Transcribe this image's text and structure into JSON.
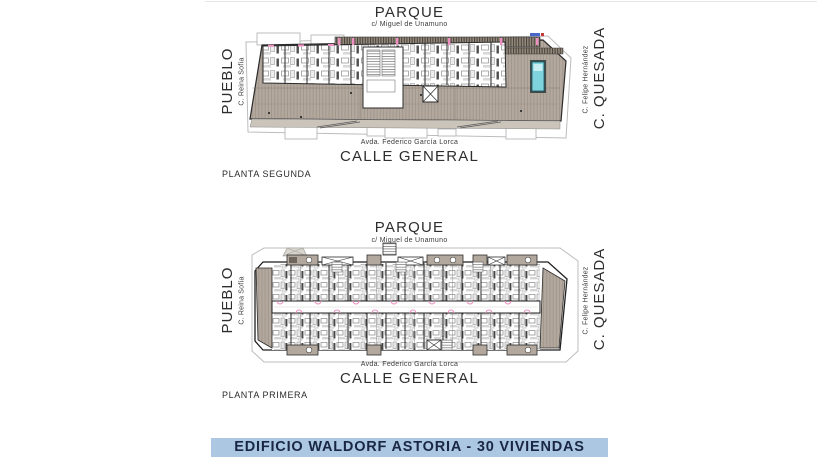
{
  "plans": [
    {
      "name": "PLANTA SEGUNDA",
      "streets": {
        "top": {
          "title": "PARQUE",
          "subtitle": "c/ Miguel de Unamuno"
        },
        "bottom": {
          "title": "CALLE GENERAL",
          "subtitle": "Avda. Federico García Lorca"
        },
        "left": {
          "title": "PUEBLO",
          "subtitle": "C. Reina Sofía"
        },
        "right": {
          "title": "C. QUESADA",
          "subtitle": "C. Felipe Hernández"
        }
      }
    },
    {
      "name": "PLANTA PRIMERA",
      "streets": {
        "top": {
          "title": "PARQUE",
          "subtitle": "c/ Miguel de Unamuno"
        },
        "bottom": {
          "title": "CALLE GENERAL",
          "subtitle": "Avda. Federico García Lorca"
        },
        "left": {
          "title": "PUEBLO",
          "subtitle": "C. Reina Sofía"
        },
        "right": {
          "title": "C. QUESADA",
          "subtitle": "C. Felipe Hernández"
        }
      }
    }
  ],
  "footer": {
    "banner_text": "EDIFICIO WALDORF ASTORIA - 30 VIVIENDAS"
  },
  "colors": {
    "banner_bg": "#abc7e2",
    "banner_text": "#1a2744",
    "terrace": "#b3a89d",
    "deck_line": "#a0968b",
    "pool": "#7ed3dc",
    "door_pink": "#ee8fc1",
    "wall": "#2e2e2e",
    "outline": "#bcbcbc"
  }
}
